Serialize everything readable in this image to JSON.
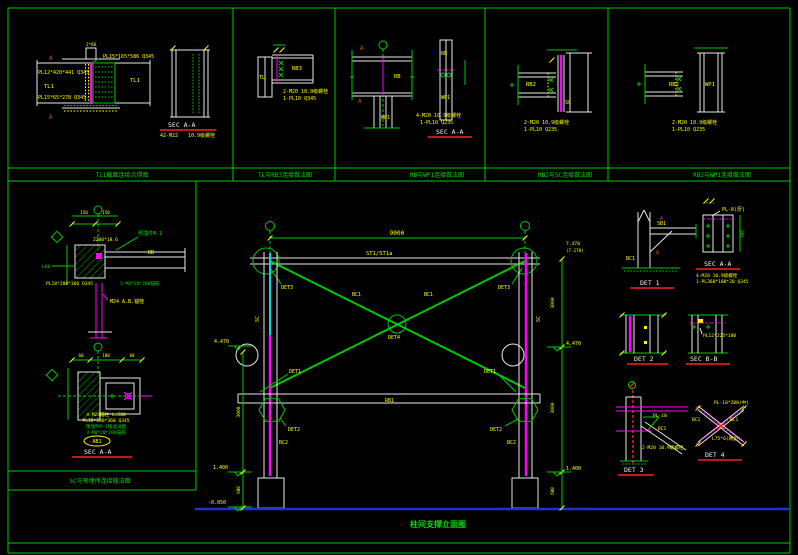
{
  "colors": {
    "background": "#000000",
    "line_green": "#00c800",
    "line_white": "#e8e8e8",
    "line_magenta": "#ff00ff",
    "line_cyan": "#00dcdc",
    "line_yellow": "#ffff00",
    "line_red": "#ff2020",
    "ground_blue": "#2233cc",
    "text_yellow": "#ffff00",
    "text_green": "#00dd00"
  },
  "band": {
    "titles": [
      "TL1截面连接点焊图",
      "TL与RB3连接做法图",
      "RB与WP1连接做法图",
      "RB2与SC连接做法图",
      "RB2与WP1连接做法图"
    ]
  },
  "left_band_title": "SC与预埋件连接做法图",
  "main_title": "柱间支撑立面图",
  "p1": {
    "plate_top": "PL15*165*586 Q345",
    "plate_mid": "PL12*420*441 Q345",
    "member_l": "TL1",
    "plate_bot": "PL15*65*270 Q345",
    "member_r": "TL1",
    "marker_a": "A",
    "dim_top": "2*60",
    "sec_title": "SEC A-A",
    "bolt_note": "42-M22",
    "grade_note": "10.9级螺栓"
  },
  "p2": {
    "member": "TL",
    "beam": "RB3",
    "note1": "2-M20 10.9级螺栓",
    "note2": "1-PL10   Q345"
  },
  "p3": {
    "marker_a": "A",
    "beam": "RB",
    "col": "WP1",
    "beam_s": "RB",
    "col_s": "WP1",
    "note1": "4-M20 10.9级螺栓",
    "note2": "1-PL10   Q235",
    "sec_title": "SEC A-A"
  },
  "p4": {
    "beam": "RB2",
    "col": "SC",
    "note1": "2-M20  10.9级螺栓",
    "note2": "1-PL10    Q235"
  },
  "p5": {
    "beam": "RB2",
    "col": "WP1",
    "note1": "2-M20  10.9级螺栓",
    "note2": "1-PL10    Q235"
  },
  "d1": {
    "embed": "预埋件M-1",
    "channel": "Z200*18.6",
    "beam": "RB",
    "stud_note": "3-M8*20*200锚筋",
    "plate": "PL18*200*360 Q345",
    "anchor": "M24 A.B.锚栓",
    "tag": "L60",
    "dim1": "150",
    "dim2": "150"
  },
  "d2": {
    "note1": "4-M24锚栓 L=500",
    "note2": "PL18*200*360 Q345",
    "note3": "预埋件M-1埋设详图",
    "note4": "3-M8*20*200锚筋",
    "tag": "AB1",
    "sec_title": "SEC A-A",
    "dim1": "60",
    "dim2": "180",
    "dim3": "60"
  },
  "elev": {
    "span_dim": "9000",
    "top_beam": "ST1/ST1a",
    "brace1": "BC1",
    "brace2": "BC1",
    "det1": "DET1",
    "det2": "DET2",
    "det3": "DET3",
    "det4": "DET4",
    "mid_beam": "RB1",
    "col_l": "SC",
    "col_r": "SC",
    "col_seg_l": "BC2",
    "col_seg_r": "BC2",
    "lvl_447_l": "4.470",
    "lvl_140_l": "1.400",
    "lvl_005": "-0.050",
    "lvl_747": "7.470",
    "lvl_717": "(7.170)",
    "lvl_447_r": "4.470",
    "lvl_140_r": "1.400",
    "dim_3000_l": "3000",
    "dim_600_l": "600",
    "dim_3000_r1": "3000",
    "dim_3000_r2": "3000",
    "dim_600_r": "600"
  },
  "r_det1": {
    "title": "DET 1",
    "sb": "SB1",
    "bc": "BC1",
    "marker_a": "A"
  },
  "r_sec_a": {
    "pl": "PL-8(厚)",
    "sec_title": "SEC A-A",
    "note1": "4-M20 10.9级螺栓",
    "note2": "1-PL360*100*20 Q345",
    "dim": "360"
  },
  "r_det2": {
    "title": "DET 2"
  },
  "r_sec_b": {
    "title": "SEC B-B",
    "pl": "PL12*225*180"
  },
  "r_det3": {
    "title": "DET 3",
    "pl": "PL-10",
    "bc": "BC1",
    "note": "2-M20 10.9级螺栓"
  },
  "r_det4": {
    "title": "DET 4",
    "pl": "PL-10*200(中)",
    "bc_l": "BC1",
    "bc_r": "BC1",
    "angle": "L75*6(两边)"
  }
}
